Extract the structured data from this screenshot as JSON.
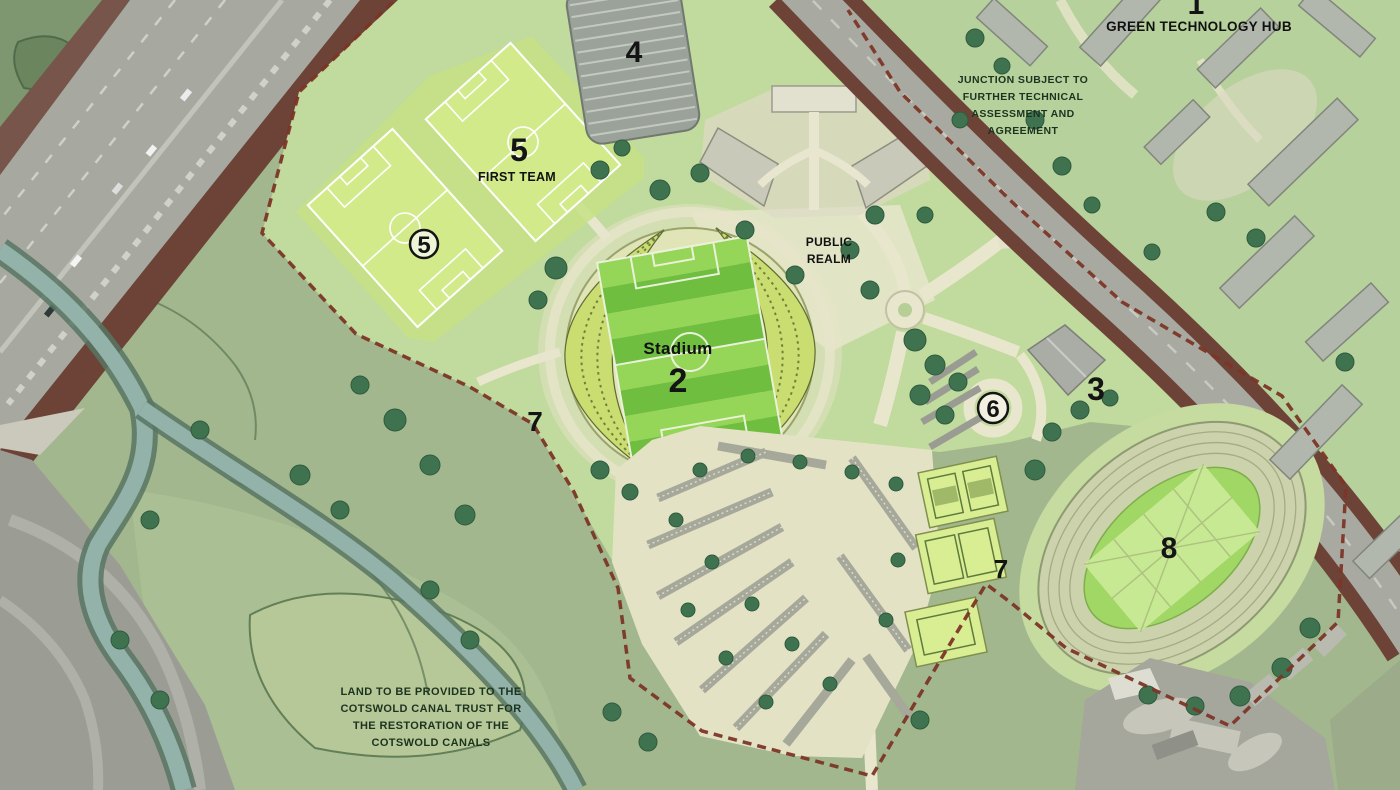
{
  "plan": {
    "markers": {
      "hub_number": "1",
      "stadium_number": "2",
      "building3_number": "3",
      "parking_structure_number": "4",
      "pitch_a_number": "5",
      "pitch_b_number": "5",
      "dropoff_number": "6",
      "boundary_number": "7",
      "courts_number": "7",
      "track_number": "8"
    },
    "labels": {
      "hub_title": "GREEN TECHNOLOGY HUB",
      "first_team": "FIRST TEAM",
      "stadium": "Stadium",
      "public_realm_line1": "PUBLIC",
      "public_realm_line2": "REALM"
    },
    "annotations": {
      "junction_line1": "JUNCTION SUBJECT TO",
      "junction_line2": "FURTHER TECHNICAL",
      "junction_line3": "ASSESSMENT AND",
      "junction_line4": "AGREEMENT",
      "canal_line1": "LAND TO BE PROVIDED TO THE",
      "canal_line2": "COTSWOLD CANAL TRUST FOR",
      "canal_line3": "THE RESTORATION OF THE",
      "canal_line4": "COTSWOLD CANALS"
    },
    "colors": {
      "field_sage": "#a2b78d",
      "site_platform": "#c1da9d",
      "pitch_lime": "#d3ea8b",
      "stadium_stripe_dark": "#6fbe40",
      "stadium_stripe_light": "#95d557",
      "stand_leaf": "#c9dd70",
      "path_cream": "#e8e6cc",
      "road_gray": "#a8aaa2",
      "canal_water": "#92b2aa",
      "boundary_red": "#7c3526",
      "roadside_maroon": "#6e4337",
      "tree_dark": "#3f7350",
      "building_gray": "#b2b7ad",
      "label_black": "#141414"
    }
  }
}
